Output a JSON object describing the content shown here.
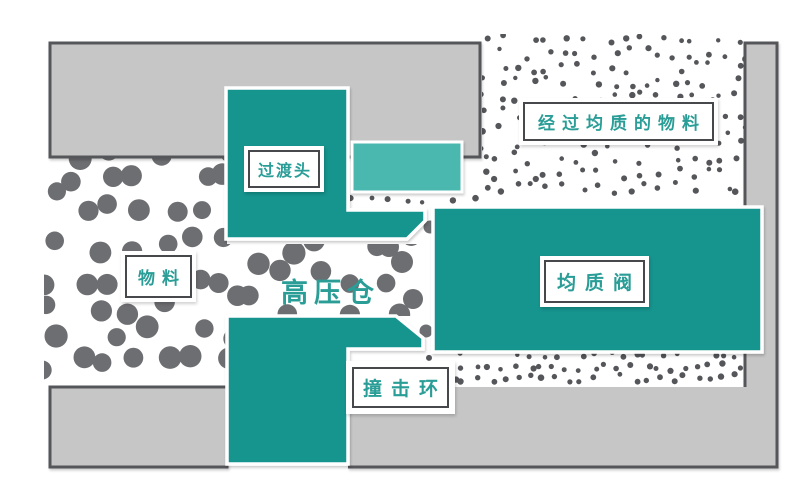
{
  "diagram": {
    "labels": {
      "material": "物料",
      "transition_head": "过渡头",
      "high_pressure_chamber": "高压仓",
      "homogenizing_valve": "均质阀",
      "impact_ring": "撞击环",
      "homogenized_material": "经过均质的物料"
    },
    "colors": {
      "teal_dark": "#18948E",
      "teal_light": "#4BB8AF",
      "label_text": "#2A9D97",
      "label_border": "#47484B",
      "wall_fill": "#C6C6C6",
      "wall_border": "#55565A",
      "dot_large": "#6D6E71",
      "dot_small": "#55565A",
      "background": "#FFFFFF"
    }
  }
}
